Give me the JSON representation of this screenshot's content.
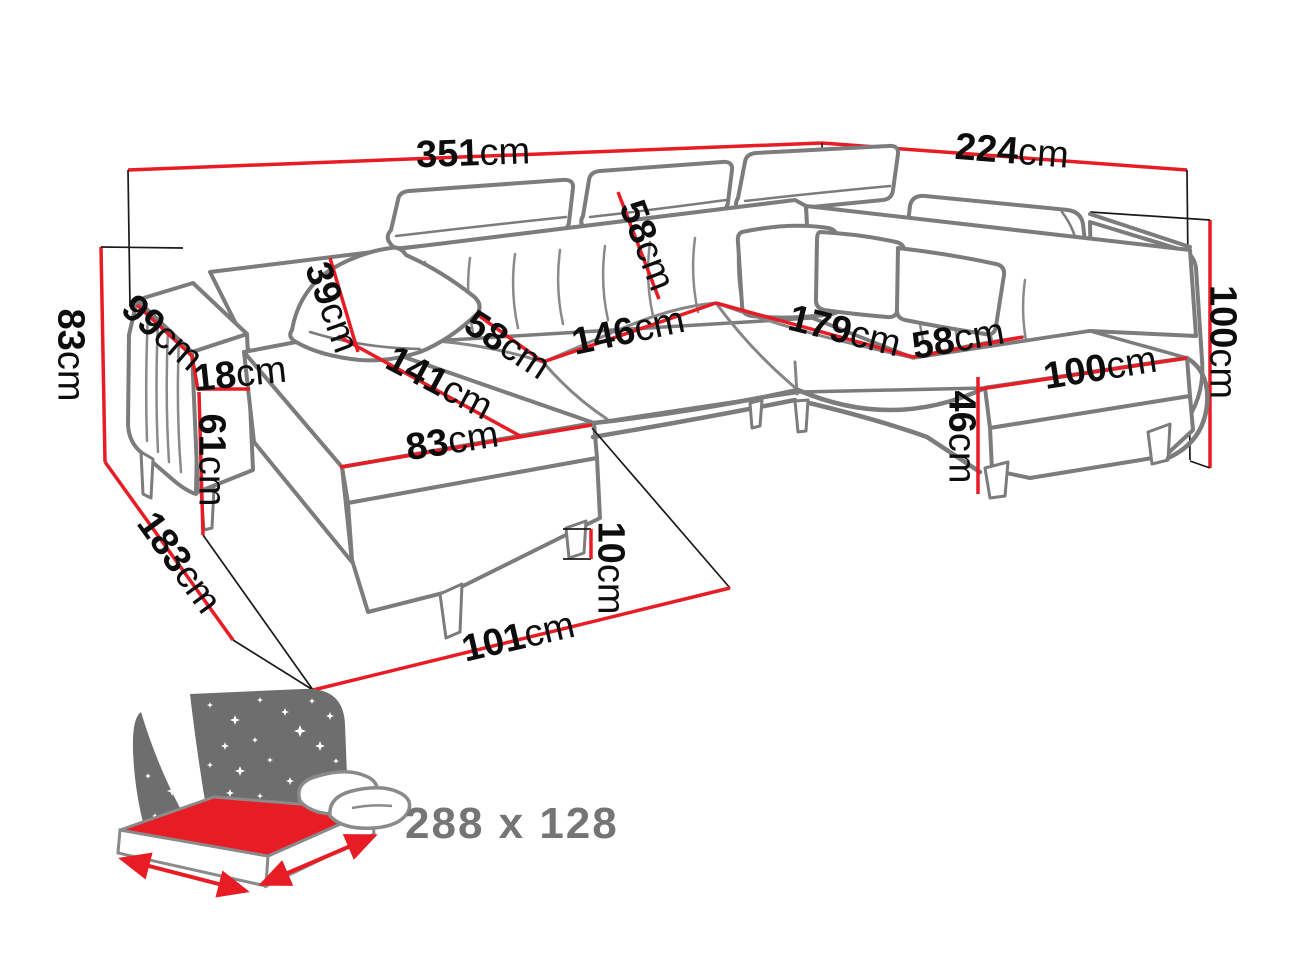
{
  "page": {
    "background": "#ffffff",
    "description": "Dimension diagram of a U-shaped corner sofa bed"
  },
  "colors": {
    "dimension_red": "#e81c24",
    "sofa_outline_gray": "#7c7c7c",
    "helper_line_black": "#1a1a1a",
    "label_black": "#0d0d0d",
    "bed_icon_gray": "#6e6e6e",
    "bed_label_gray": "#757575"
  },
  "diagram": {
    "type": "furniture-dimension-diagram",
    "unit_system": "centimeters",
    "dimensions": [
      {
        "id": "total-back-width",
        "num": "351",
        "unit": "cm"
      },
      {
        "id": "right-back-depth",
        "num": "224",
        "unit": "cm"
      },
      {
        "id": "back-height-left",
        "num": "83",
        "unit": "cm"
      },
      {
        "id": "armrest-length",
        "num": "99",
        "unit": "cm"
      },
      {
        "id": "armrest-width",
        "num": "18",
        "unit": "cm"
      },
      {
        "id": "armrest-height",
        "num": "61",
        "unit": "cm"
      },
      {
        "id": "chaise-total-depth",
        "num": "183",
        "unit": "cm"
      },
      {
        "id": "headrest-height",
        "num": "39",
        "unit": "cm"
      },
      {
        "id": "chaise-length",
        "num": "141",
        "unit": "cm"
      },
      {
        "id": "chaise-width",
        "num": "83",
        "unit": "cm"
      },
      {
        "id": "seat-depth-left",
        "num": "58",
        "unit": "cm"
      },
      {
        "id": "center-seat-width",
        "num": "146",
        "unit": "cm"
      },
      {
        "id": "backrest-height",
        "num": "58",
        "unit": "cm"
      },
      {
        "id": "right-section-length",
        "num": "179",
        "unit": "cm"
      },
      {
        "id": "seat-depth-right",
        "num": "58",
        "unit": "cm"
      },
      {
        "id": "right-seat-width",
        "num": "100",
        "unit": "cm"
      },
      {
        "id": "seat-height",
        "num": "46",
        "unit": "cm"
      },
      {
        "id": "leg-height",
        "num": "10",
        "unit": "cm"
      },
      {
        "id": "front-return-width",
        "num": "101",
        "unit": "cm"
      },
      {
        "id": "back-height-right",
        "num": "100",
        "unit": "cm"
      }
    ],
    "bed": {
      "label": "288 x 128"
    }
  }
}
